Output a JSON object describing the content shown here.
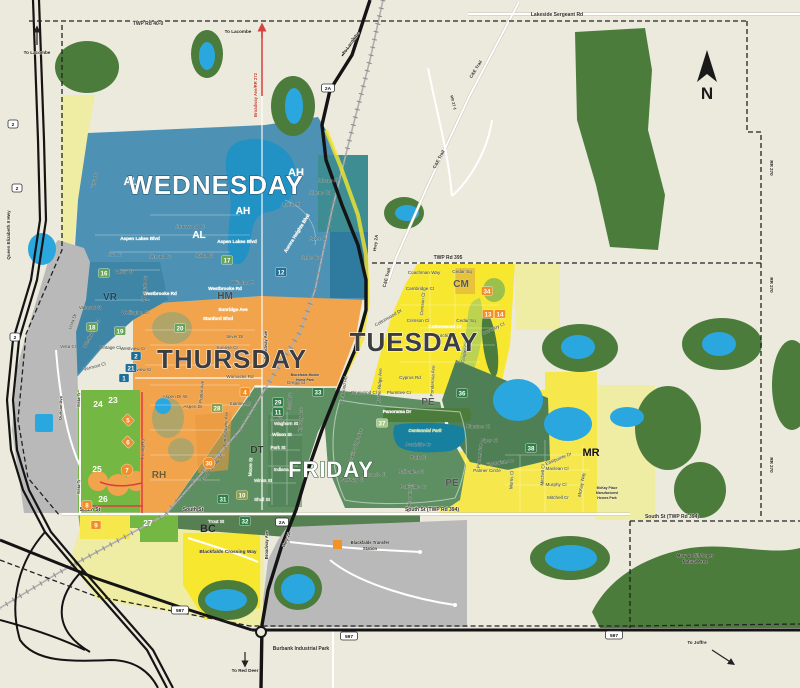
{
  "colors": {
    "background": "#ECE9DD",
    "forest": "#4C7C3C",
    "water": "#2BA7E0",
    "lake_dark": "#2291C4",
    "wednesday_blue": "#4D92B4",
    "thursday_orange": "#F2A44D",
    "tuesday_yellow": "#F8E72F",
    "friday_green": "#5E8F62",
    "pale_yellow": "#EFECA3",
    "bright_green": "#74B843",
    "gray_zone": "#B9B9B9",
    "badge_blue": "#1E6E96",
    "badge_green": "#2F7E47",
    "badge_orange": "#F28E27",
    "road_red": "#D84040",
    "boundary_dash": "#222222"
  },
  "compass": {
    "label": "N"
  },
  "zone_titles": [
    {
      "t": "WEDNESDAY",
      "x": 216,
      "y": 194,
      "s": 26,
      "c": "#FDFDFD",
      "sc": "#1c4c66"
    },
    {
      "t": "THURSDAY",
      "x": 232,
      "y": 368,
      "s": 26,
      "c": "#3D3D40",
      "sc": "#FFFFFF"
    },
    {
      "t": "TUESDAY",
      "x": 414,
      "y": 351,
      "s": 26,
      "c": "#3D3D40",
      "sc": "#FFFFFF"
    },
    {
      "t": "FRIDAY",
      "x": 331,
      "y": 477,
      "s": 22,
      "c": "#FDFDFD",
      "sc": "#2d5c37"
    }
  ],
  "district_codes": [
    {
      "t": "AH",
      "x": 296,
      "y": 176,
      "s": 11,
      "c": "#FFFFFF"
    },
    {
      "t": "AH",
      "x": 243,
      "y": 214,
      "s": 10,
      "c": "#FFFFFF"
    },
    {
      "t": "AL",
      "x": 131,
      "y": 185,
      "s": 11,
      "c": "#FFFFFF"
    },
    {
      "t": "AL",
      "x": 199,
      "y": 238,
      "s": 10,
      "c": "#FFFFFF"
    },
    {
      "t": "VR",
      "x": 110,
      "y": 300,
      "s": 10,
      "c": "#17465c"
    },
    {
      "t": "HM",
      "x": 225,
      "y": 299,
      "s": 10,
      "c": "#494949"
    },
    {
      "t": "CM",
      "x": 461,
      "y": 287,
      "s": 10,
      "c": "#565656"
    },
    {
      "t": "PE",
      "x": 428,
      "y": 405,
      "s": 10,
      "c": "#565656"
    },
    {
      "t": "PE",
      "x": 452,
      "y": 486,
      "s": 10,
      "c": "#565656"
    },
    {
      "t": "DT",
      "x": 257,
      "y": 453,
      "s": 10,
      "c": "#2F3B2F"
    },
    {
      "t": "RH",
      "x": 159,
      "y": 478,
      "s": 10,
      "c": "#6b5b33"
    },
    {
      "t": "BC",
      "x": 208,
      "y": 532,
      "s": 11,
      "c": "#222222"
    },
    {
      "t": "MR",
      "x": 591,
      "y": 456,
      "s": 11,
      "c": "#111111"
    }
  ],
  "street_labels": [
    {
      "t": "Vista Tr",
      "x": 96,
      "y": 181,
      "r": -75
    },
    {
      "t": "Aspen Lakes Blvd",
      "x": 140,
      "y": 240,
      "c": "#FFFFFF",
      "w": 1
    },
    {
      "t": "Aspen Lakes Blvd",
      "x": 237,
      "y": 243,
      "c": "#FFFFFF",
      "w": 1
    },
    {
      "t": "Ava Cr",
      "x": 115,
      "y": 256
    },
    {
      "t": "Almond Cr",
      "x": 160,
      "y": 258
    },
    {
      "t": "Adina Ct",
      "x": 204,
      "y": 257
    },
    {
      "t": "Arrowwood Ct",
      "x": 190,
      "y": 228
    },
    {
      "t": "Aurora Heights Blvd",
      "x": 298,
      "y": 234,
      "r": -58,
      "c": "#FFFFFF",
      "w": 1
    },
    {
      "t": "Athens Rd",
      "x": 320,
      "y": 194
    },
    {
      "t": "Athens Pl",
      "x": 291,
      "y": 206
    },
    {
      "t": "Athans Pl",
      "x": 328,
      "y": 182
    },
    {
      "t": "Aztec St",
      "x": 318,
      "y": 240
    },
    {
      "t": "Aztec Cr",
      "x": 310,
      "y": 259
    },
    {
      "t": "Valley Cr",
      "x": 124,
      "y": 273
    },
    {
      "t": "Valmont St",
      "x": 90,
      "y": 309
    },
    {
      "t": "Vista Dr",
      "x": 74,
      "y": 322,
      "r": -70
    },
    {
      "t": "Vista Cl",
      "x": 68,
      "y": 348
    },
    {
      "t": "Vintage Cl",
      "x": 110,
      "y": 349
    },
    {
      "t": "Vermont Cl",
      "x": 95,
      "y": 368,
      "r": -15
    },
    {
      "t": "Westbrooke Rd",
      "x": 93,
      "y": 334,
      "r": -63
    },
    {
      "t": "Westbrooke Rd",
      "x": 160,
      "y": 295,
      "c": "#FFFFFF",
      "w": 1
    },
    {
      "t": "Westbrooke Rd",
      "x": 225,
      "y": 290,
      "c": "#FFFFFF",
      "w": 1
    },
    {
      "t": "Winston Pl",
      "x": 243,
      "y": 284
    },
    {
      "t": "Westgate Cr",
      "x": 146,
      "y": 289,
      "r": -85
    },
    {
      "t": "Wellington Cl",
      "x": 135,
      "y": 314
    },
    {
      "t": "Sunridge Ave",
      "x": 233,
      "y": 311,
      "c": "#FFFFFF",
      "w": 1
    },
    {
      "t": "Stanford Blvd",
      "x": 218,
      "y": 320,
      "c": "#FFFFFF",
      "w": 1
    },
    {
      "t": "Silver Dr",
      "x": 235,
      "y": 338
    },
    {
      "t": "Sunrise Cl",
      "x": 227,
      "y": 349
    },
    {
      "t": "Westview Cr",
      "x": 133,
      "y": 350
    },
    {
      "t": "Westview Cr",
      "x": 139,
      "y": 371
    },
    {
      "t": "Womacks Rd",
      "x": 240,
      "y": 378
    },
    {
      "t": "Aspen Dr W",
      "x": 175,
      "y": 398
    },
    {
      "t": "Aspen Dr",
      "x": 193,
      "y": 408
    },
    {
      "t": "Poplar Ave",
      "x": 203,
      "y": 392,
      "r": -85
    },
    {
      "t": "Stanley St",
      "x": 240,
      "y": 405
    },
    {
      "t": "Leung Rd",
      "x": 144,
      "y": 449,
      "r": -87
    },
    {
      "t": "Landsdowne Ave",
      "x": 227,
      "y": 429,
      "r": -87
    },
    {
      "t": "Gregg St",
      "x": 296,
      "y": 384
    },
    {
      "t": "East Railway St",
      "x": 213,
      "y": 469,
      "r": -52
    },
    {
      "t": "Waghorn St",
      "x": 286,
      "y": 425,
      "c": "#FFFFFF"
    },
    {
      "t": "Wilson St",
      "x": 282,
      "y": 436,
      "c": "#FFFFFF"
    },
    {
      "t": "Park St",
      "x": 278,
      "y": 449,
      "c": "#FFFFFF"
    },
    {
      "t": "Indiana St",
      "x": 284,
      "y": 471,
      "c": "#FFFFFF"
    },
    {
      "t": "Winks St",
      "x": 263,
      "y": 482,
      "c": "#FFFFFF"
    },
    {
      "t": "Shull St",
      "x": 262,
      "y": 501,
      "c": "#FFFFFF"
    },
    {
      "t": "Moore St",
      "x": 252,
      "y": 467,
      "r": -87,
      "c": "#FFFFFF"
    },
    {
      "t": "East Ave",
      "x": 291,
      "y": 402,
      "r": -87
    },
    {
      "t": "Leyton Ave",
      "x": 282,
      "y": 410,
      "r": -87
    },
    {
      "t": "Highway Ave",
      "x": 302,
      "y": 421,
      "r": -87
    },
    {
      "t": "Trout St",
      "x": 216,
      "y": 523,
      "c": "#FFFFFF"
    },
    {
      "t": "Panorama Dr",
      "x": 397,
      "y": 413,
      "c": "#FFFFFF",
      "w": 1
    },
    {
      "t": "Pondside Cr",
      "x": 418,
      "y": 446
    },
    {
      "t": "Park St",
      "x": 418,
      "y": 459
    },
    {
      "t": "Palisades St",
      "x": 411,
      "y": 473
    },
    {
      "t": "Parkridge Cr",
      "x": 413,
      "y": 488
    },
    {
      "t": "Pinnacle Cl",
      "x": 374,
      "y": 476
    },
    {
      "t": "Parkway Cl",
      "x": 352,
      "y": 481
    },
    {
      "t": "Parkwood Rd",
      "x": 345,
      "y": 390,
      "r": -80
    },
    {
      "t": "Prairie Ridge Ave",
      "x": 357,
      "y": 446,
      "r": -72
    },
    {
      "t": "Parkmount Cr",
      "x": 411,
      "y": 498,
      "r": -85
    },
    {
      "t": "Pinewood Cl",
      "x": 364,
      "y": 394
    },
    {
      "t": "Plumtree Cr",
      "x": 399,
      "y": 394
    },
    {
      "t": "Pinetree Cl",
      "x": 478,
      "y": 428
    },
    {
      "t": "Piper Cl",
      "x": 489,
      "y": 442
    },
    {
      "t": "Pioneer Ave",
      "x": 481,
      "y": 456,
      "r": -85
    },
    {
      "t": "Palmer Circle",
      "x": 487,
      "y": 472
    },
    {
      "t": "Coachman Way",
      "x": 424,
      "y": 274
    },
    {
      "t": "Cedar Sq",
      "x": 462,
      "y": 273
    },
    {
      "t": "Cedar Sq",
      "x": 466,
      "y": 322
    },
    {
      "t": "Cambridge Ct",
      "x": 420,
      "y": 290
    },
    {
      "t": "Crimson Ct",
      "x": 424,
      "y": 304,
      "r": -85
    },
    {
      "t": "Crimson Cl",
      "x": 418,
      "y": 322
    },
    {
      "t": "Cottonwood Dr",
      "x": 389,
      "y": 319,
      "r": -30
    },
    {
      "t": "Cottonwood Dr",
      "x": 445,
      "y": 328,
      "c": "#FFFFFF",
      "w": 1
    },
    {
      "t": "Churchill Pl",
      "x": 444,
      "y": 337
    },
    {
      "t": "Coventry Cl",
      "x": 494,
      "y": 330,
      "r": -25
    },
    {
      "t": "Cyprus Rd",
      "x": 410,
      "y": 379
    },
    {
      "t": "Ponderosa Ave",
      "x": 434,
      "y": 381,
      "r": -87
    },
    {
      "t": "Cooper Cl",
      "x": 466,
      "y": 353,
      "r": -78
    },
    {
      "t": "Prairie Ridge Ave",
      "x": 381,
      "y": 386,
      "r": -87
    },
    {
      "t": "Eastpointe Dr",
      "x": 500,
      "y": 464,
      "r": -8
    },
    {
      "t": "Eastpointe Dr",
      "x": 559,
      "y": 460,
      "r": -22
    },
    {
      "t": "Maclean Cl",
      "x": 557,
      "y": 470
    },
    {
      "t": "Murphy Cl",
      "x": 556,
      "y": 486
    },
    {
      "t": "Mitchell Cr",
      "x": 558,
      "y": 499
    },
    {
      "t": "Mitchell Cl",
      "x": 544,
      "y": 475,
      "r": -87
    },
    {
      "t": "Morris Cl",
      "x": 513,
      "y": 480,
      "r": -87
    },
    {
      "t": "McKay Way",
      "x": 583,
      "y": 485,
      "r": -80
    }
  ],
  "road_labels": [
    {
      "t": "TWP Rd 40-0",
      "x": 148,
      "y": 25
    },
    {
      "t": "Lakeside Sergeant Rd",
      "x": 557,
      "y": 16
    },
    {
      "t": "TWP Rd 395",
      "x": 448,
      "y": 259
    },
    {
      "t": "South St",
      "x": 90,
      "y": 511
    },
    {
      "t": "South St",
      "x": 193,
      "y": 511
    },
    {
      "t": "South St (TWP Rd 394)",
      "x": 432,
      "y": 511
    },
    {
      "t": "South St (TWP Rd 394)",
      "x": 672,
      "y": 518
    },
    {
      "t": "RR 270",
      "x": 770,
      "y": 168,
      "r": 90,
      "s": 4.5
    },
    {
      "t": "RR 270",
      "x": 770,
      "y": 285,
      "r": 90,
      "s": 4.5
    },
    {
      "t": "RR 270",
      "x": 770,
      "y": 465,
      "r": 90,
      "s": 4.5
    },
    {
      "t": "RR 27-1",
      "x": 452,
      "y": 103,
      "r": 75,
      "s": 4
    },
    {
      "t": "Queen Elizabeth II Hwy",
      "x": 10,
      "y": 235,
      "r": -90,
      "s": 4.5
    },
    {
      "t": "Broadway Ave/RR 272",
      "x": 257,
      "y": 95,
      "r": -90,
      "s": 4.2,
      "c": "#C0392B"
    },
    {
      "t": "Broadway Ave",
      "x": 267,
      "y": 345,
      "r": -90,
      "s": 4.2
    },
    {
      "t": "Broadway Ave",
      "x": 268,
      "y": 545,
      "r": -90,
      "s": 4.2
    },
    {
      "t": "C&E Trail",
      "x": 477,
      "y": 70,
      "r": -58,
      "s": 4.5
    },
    {
      "t": "C&E Trail",
      "x": 440,
      "y": 160,
      "r": -62,
      "s": 4.5
    },
    {
      "t": "C&E Trail",
      "x": 388,
      "y": 278,
      "r": -75,
      "s": 4.5
    },
    {
      "t": "Hwy 2A",
      "x": 377,
      "y": 243,
      "r": -83,
      "s": 4.5
    },
    {
      "t": "Hwy 2A",
      "x": 288,
      "y": 540,
      "r": -68,
      "s": 4.5
    },
    {
      "t": "Duncan Ave",
      "x": 62,
      "y": 408,
      "r": -88,
      "s": 4.2
    },
    {
      "t": "Vista Tr",
      "x": 80,
      "y": 400,
      "r": -88,
      "s": 4.2
    },
    {
      "t": "Vista Tr",
      "x": 80,
      "y": 487,
      "r": -88,
      "s": 4.2
    }
  ],
  "landmark_labels": [
    {
      "t": "Blackfalds Crossing Way",
      "x": 228,
      "y": 553,
      "s": 4.8
    },
    {
      "t": "Blackfalds Transfer",
      "x": 370,
      "y": 544,
      "s": 4.2
    },
    {
      "t": "Station",
      "x": 370,
      "y": 550,
      "s": 4.2
    },
    {
      "t": "Burbank Industrial Park",
      "x": 301,
      "y": 650,
      "s": 5
    },
    {
      "t": "Mary & Cliff Soper",
      "x": 695,
      "y": 557,
      "s": 4.2
    },
    {
      "t": "Natural Area",
      "x": 695,
      "y": 563,
      "s": 4.2
    },
    {
      "t": "McKay Place",
      "x": 607,
      "y": 489,
      "s": 3.4
    },
    {
      "t": "Manufactured",
      "x": 607,
      "y": 494,
      "s": 3.4
    },
    {
      "t": "Homes Park",
      "x": 607,
      "y": 499,
      "s": 3.4
    },
    {
      "t": "Blackfalds Mobile",
      "x": 305,
      "y": 376,
      "s": 3.4
    },
    {
      "t": "Home Park",
      "x": 305,
      "y": 381,
      "s": 3.4
    },
    {
      "t": "Centennial Park",
      "x": 425,
      "y": 432,
      "s": 4.4,
      "c": "#CFE49A",
      "i": 1
    }
  ],
  "direction_labels": [
    {
      "t": "To Lacombe",
      "x": 37,
      "y": 54
    },
    {
      "t": "To Lacombe",
      "x": 238,
      "y": 33
    },
    {
      "t": "To Lacombe",
      "x": 352,
      "y": 44,
      "r": -55
    },
    {
      "t": "To Red Deer",
      "x": 245,
      "y": 672
    },
    {
      "t": "To Joffre",
      "x": 697,
      "y": 644
    }
  ],
  "badges": [
    {
      "n": "12",
      "x": 281,
      "y": 272,
      "k": "b"
    },
    {
      "n": "17",
      "x": 227,
      "y": 260,
      "k": "g"
    },
    {
      "n": "16",
      "x": 104,
      "y": 273,
      "k": "g"
    },
    {
      "n": "18",
      "x": 92,
      "y": 327,
      "k": "g"
    },
    {
      "n": "19",
      "x": 120,
      "y": 331,
      "k": "g"
    },
    {
      "n": "20",
      "x": 180,
      "y": 328,
      "k": "g"
    },
    {
      "n": "2",
      "x": 136,
      "y": 356,
      "k": "b"
    },
    {
      "n": "21",
      "x": 131,
      "y": 368,
      "k": "b"
    },
    {
      "n": "1",
      "x": 124,
      "y": 378,
      "k": "b"
    },
    {
      "n": "4",
      "x": 245,
      "y": 392,
      "k": "o"
    },
    {
      "n": "28",
      "x": 217,
      "y": 408,
      "k": "ol"
    },
    {
      "n": "29",
      "x": 278,
      "y": 402,
      "k": "gd"
    },
    {
      "n": "11",
      "x": 278,
      "y": 412,
      "k": "gd"
    },
    {
      "n": "33",
      "x": 318,
      "y": 392,
      "k": "gd"
    },
    {
      "n": "30",
      "x": 209,
      "y": 463,
      "k": "oc"
    },
    {
      "n": "31",
      "x": 223,
      "y": 499,
      "k": "gd"
    },
    {
      "n": "10",
      "x": 242,
      "y": 495,
      "k": "ol"
    },
    {
      "n": "32",
      "x": 245,
      "y": 521,
      "k": "gd"
    },
    {
      "n": "27",
      "x": 148,
      "y": 523,
      "k": "p"
    },
    {
      "n": "24",
      "x": 98,
      "y": 404,
      "k": "p"
    },
    {
      "n": "23",
      "x": 113,
      "y": 400,
      "k": "p"
    },
    {
      "n": "25",
      "x": 97,
      "y": 469,
      "k": "p"
    },
    {
      "n": "26",
      "x": 103,
      "y": 499,
      "k": "p"
    },
    {
      "n": "5",
      "x": 128,
      "y": 420,
      "k": "od"
    },
    {
      "n": "6",
      "x": 128,
      "y": 442,
      "k": "od"
    },
    {
      "n": "7",
      "x": 127,
      "y": 470,
      "k": "oc"
    },
    {
      "n": "8",
      "x": 87,
      "y": 505,
      "k": "o"
    },
    {
      "n": "9",
      "x": 96,
      "y": 525,
      "k": "o"
    },
    {
      "n": "34",
      "x": 487,
      "y": 291,
      "k": "o"
    },
    {
      "n": "13",
      "x": 488,
      "y": 314,
      "k": "o"
    },
    {
      "n": "14",
      "x": 500,
      "y": 314,
      "k": "o"
    },
    {
      "n": "36",
      "x": 462,
      "y": 393,
      "k": "gd"
    },
    {
      "n": "37",
      "x": 382,
      "y": 423,
      "k": "lg"
    },
    {
      "n": "38",
      "x": 531,
      "y": 448,
      "k": "gd"
    }
  ],
  "shields": [
    {
      "t": "2",
      "x": 13,
      "y": 124
    },
    {
      "t": "2",
      "x": 17,
      "y": 188
    },
    {
      "t": "2",
      "x": 15,
      "y": 337
    },
    {
      "t": "2A",
      "x": 328,
      "y": 88
    },
    {
      "t": "2A",
      "x": 282,
      "y": 522
    },
    {
      "t": "597",
      "x": 180,
      "y": 610
    },
    {
      "t": "597",
      "x": 349,
      "y": 636
    },
    {
      "t": "597",
      "x": 614,
      "y": 635
    }
  ]
}
